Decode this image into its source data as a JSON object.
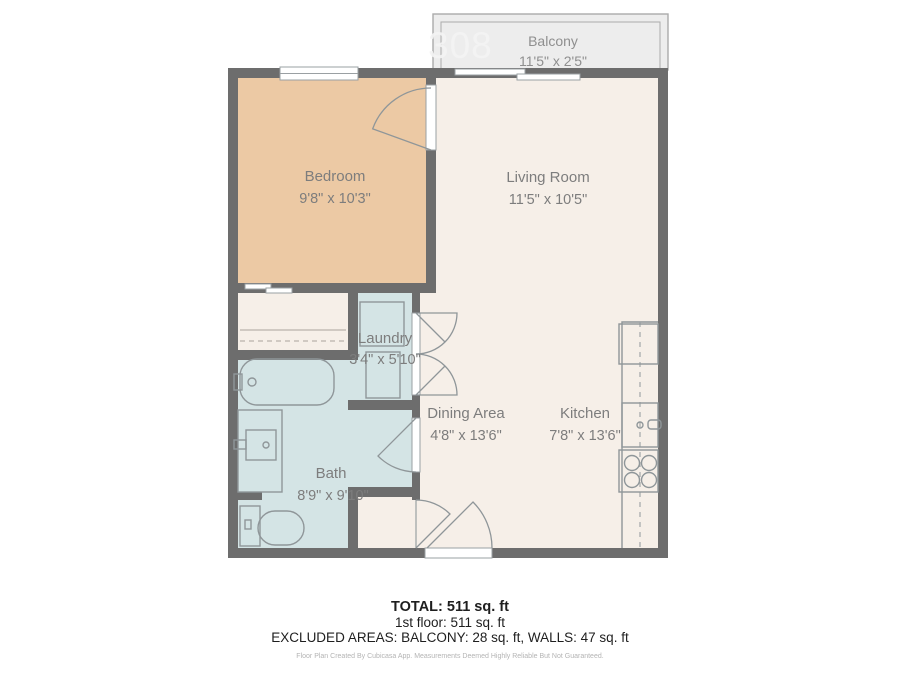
{
  "watermark": "308",
  "rooms": {
    "balcony": {
      "name": "Balcony",
      "dims": "11'5\" x 2'5\""
    },
    "bedroom": {
      "name": "Bedroom",
      "dims": "9'8\" x 10'3\""
    },
    "living": {
      "name": "Living Room",
      "dims": "11'5\" x 10'5\""
    },
    "laundry": {
      "name": "Laundry",
      "dims": "3'4\" x 5'10\""
    },
    "bath": {
      "name": "Bath",
      "dims": "8'9\" x 9'10\""
    },
    "dining": {
      "name": "Dining Area",
      "dims": "4'8\" x 13'6\""
    },
    "kitchen": {
      "name": "Kitchen",
      "dims": "7'8\" x 13'6\""
    }
  },
  "summary": {
    "total": "TOTAL: 511 sq. ft",
    "floor": "1st floor: 511 sq. ft",
    "excluded": "EXCLUDED AREAS: BALCONY: 28 sq. ft, WALLS: 47 sq. ft",
    "disclaimer": "Floor Plan Created By Cubicasa App. Measurements Deemed Highly Reliable But Not Guaranteed."
  },
  "colors": {
    "wall": "#6d6d6d",
    "floor_cream": "#f6efe8",
    "bedroom_fill": "#ecc9a4",
    "wet_room_fill": "#d4e4e5",
    "balcony_fill": "#ededed",
    "label_text": "#7d7d7d"
  }
}
